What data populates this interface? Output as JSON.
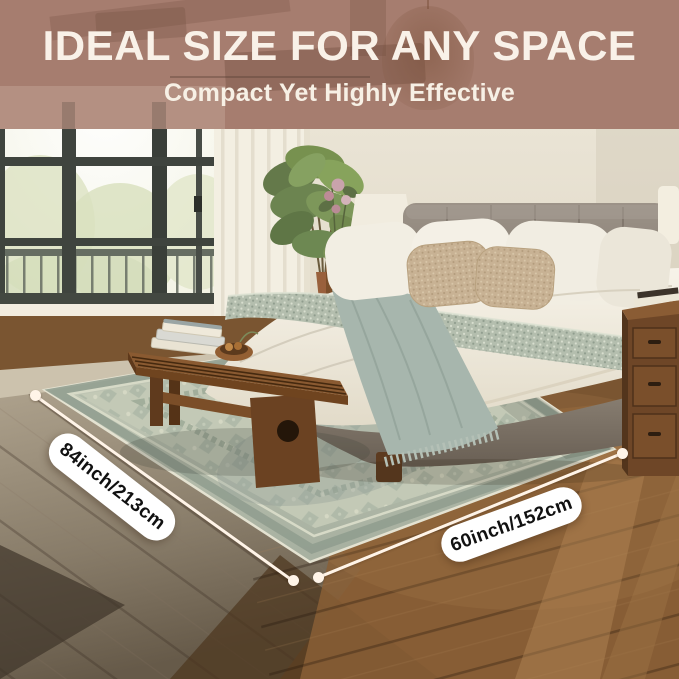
{
  "header": {
    "title": "IDEAL SIZE FOR ANY SPACE",
    "subtitle": "Compact Yet Highly Effective"
  },
  "measurements": {
    "length_label": "84inch/213cm",
    "width_label": "60inch/152cm"
  },
  "scene_objects": [
    "upholstered-bed",
    "vintage-sage-rug",
    "wood-bench",
    "book-stack",
    "fruit-bowl",
    "nightstand",
    "table-lamp",
    "corner-plant",
    "balcony-window",
    "sheer-curtain",
    "pendant-lamp"
  ],
  "colors": {
    "banner_overlay": "#a67d6f",
    "heading_text": "#f9f1e8",
    "pill_background": "#ffffff",
    "pill_text": "#111111",
    "measure_line": "#fff4e8",
    "rug_sage": "#bcc3b2",
    "floor_brown": "#7a5531",
    "headboard_taupe": "#8d8378",
    "throw_sage": "#a7b6ad"
  }
}
